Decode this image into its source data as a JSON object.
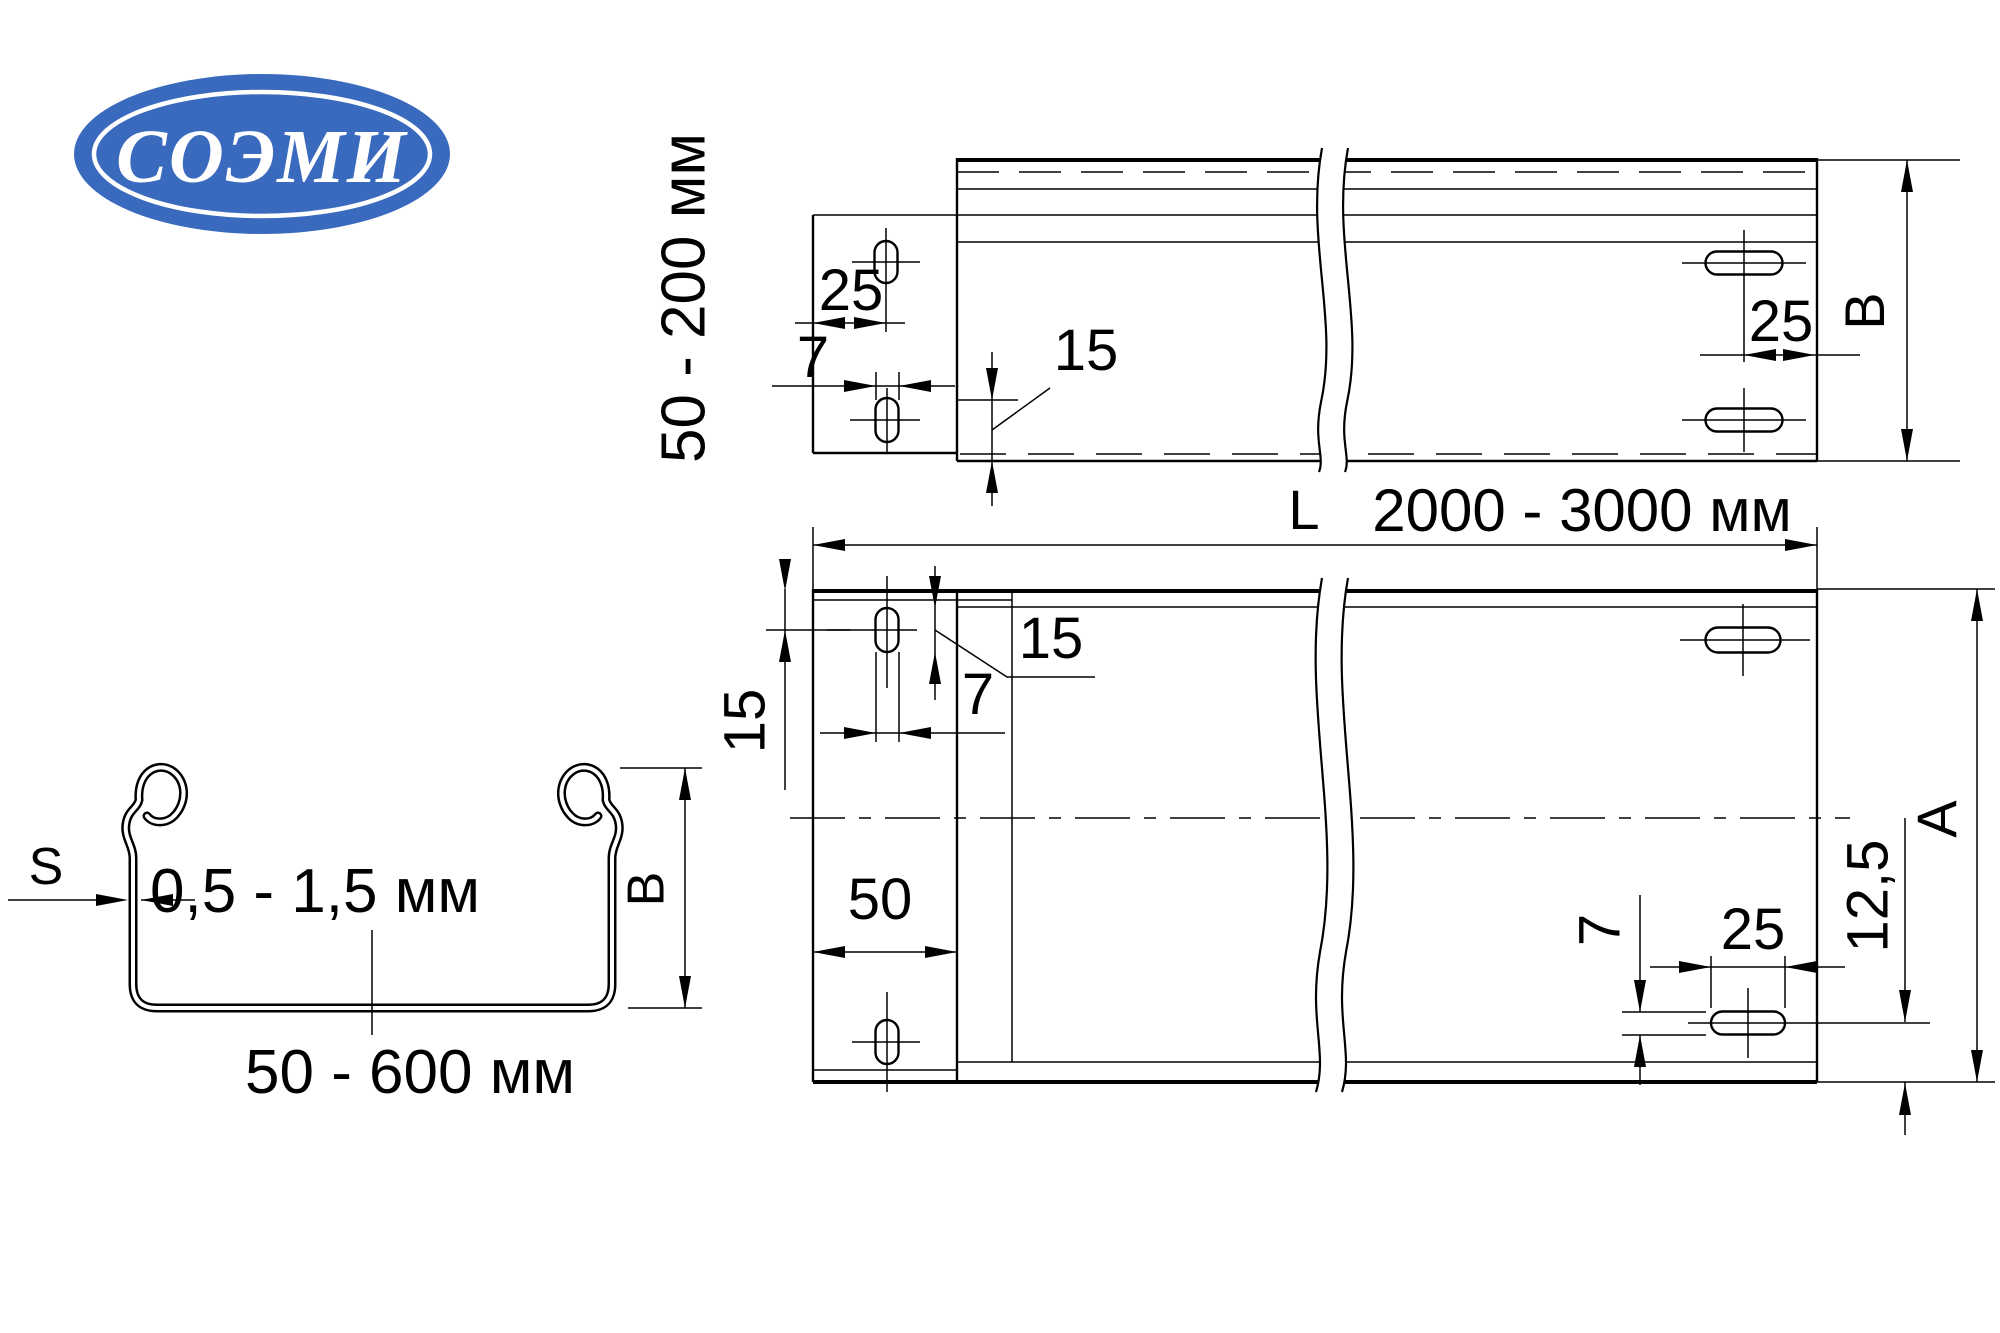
{
  "logo": {
    "text": "СОЭМИ",
    "ellipse_color": "#3a6abe",
    "text_color": "#ffffff"
  },
  "drawing": {
    "line_color": "#000000",
    "background": "#ffffff"
  },
  "side_view": {
    "height_range_label": "50 - 200 мм",
    "dim_tab_hole_offset": "25",
    "dim_hole_width": "7",
    "dim_hole_length": "15",
    "dim_edge_hole_offset": "25",
    "dim_height": "B"
  },
  "plan_view": {
    "length_prefix": "L",
    "length_range": "2000 - 3000 мм",
    "dim_hole_length": "15",
    "dim_hole_width": "7",
    "dim_hole_top_offset": "15",
    "dim_tab_width": "50",
    "dim_right_hole_width": "7",
    "dim_right_hole_length": "25",
    "dim_bottom_offset": "12,5",
    "dim_width": "A"
  },
  "section_view": {
    "thickness_label": "S",
    "thickness_range": "0,5 - 1,5 мм",
    "dim_height": "B",
    "width_range": "50 - 600 мм"
  }
}
